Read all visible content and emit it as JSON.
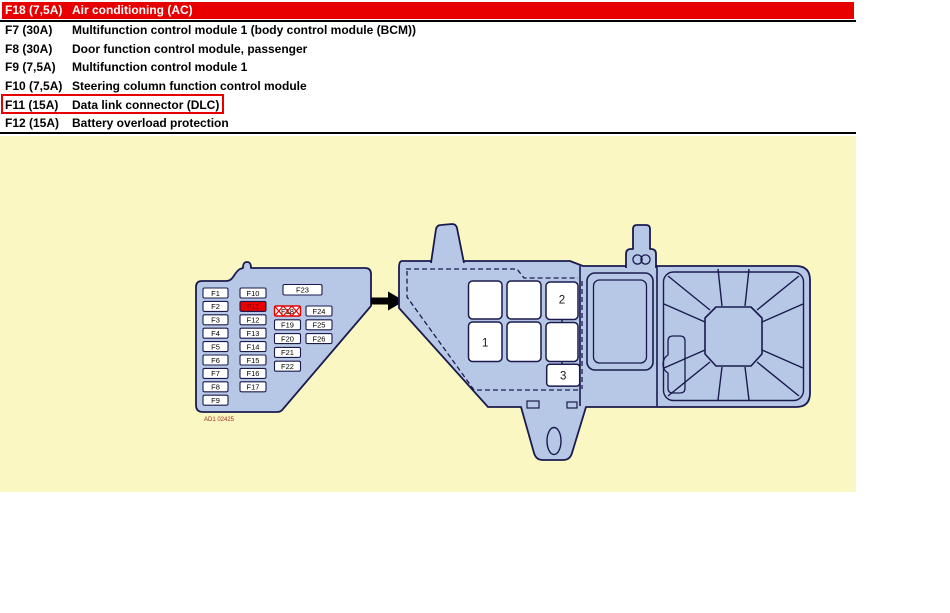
{
  "colors": {
    "highlight_red": "#e80000",
    "panel_yellow": "#fbf7c2",
    "box_blue": "#b7c8e6",
    "outline_navy": "#1a1a4e"
  },
  "fuse_table": {
    "selected_row": {
      "fuse": "F18 (7,5A)",
      "description": "Air conditioning (AC)"
    },
    "rows": [
      {
        "fuse": "F7 (30A)",
        "description": "Multifunction control module 1 (body control module (BCM))"
      },
      {
        "fuse": "F8 (30A)",
        "description": "Door function control module, passenger"
      },
      {
        "fuse": "F9 (7,5A)",
        "description": "Multifunction control module 1"
      },
      {
        "fuse": "F10 (7,5A)",
        "description": "Steering column function control module"
      },
      {
        "fuse": "F11 (15A)",
        "description": "Data link connector (DLC)"
      },
      {
        "fuse": "F12 (15A)",
        "description": "Battery overload protection"
      }
    ],
    "outlined_row_fuse": "F11 (15A)"
  },
  "diagram": {
    "interior_fuse_box": {
      "column1": [
        "F1",
        "F2",
        "F3",
        "F4",
        "F5",
        "F6",
        "F7",
        "F8",
        "F9"
      ],
      "column2": [
        "F10",
        "F11",
        "F12",
        "F13",
        "F14",
        "F15",
        "F16",
        "F17"
      ],
      "top_fuse": "F23",
      "column3": [
        "F18",
        "F19",
        "F20",
        "F21",
        "F22"
      ],
      "column4": [
        "F24",
        "F25",
        "F26"
      ],
      "highlighted_fuse": "F11",
      "crossed_out_fuse": "F18",
      "figure_code": "AD1 02425"
    },
    "engine_fuse_box": {
      "slot_labels": [
        "1",
        "2",
        "3"
      ]
    }
  }
}
